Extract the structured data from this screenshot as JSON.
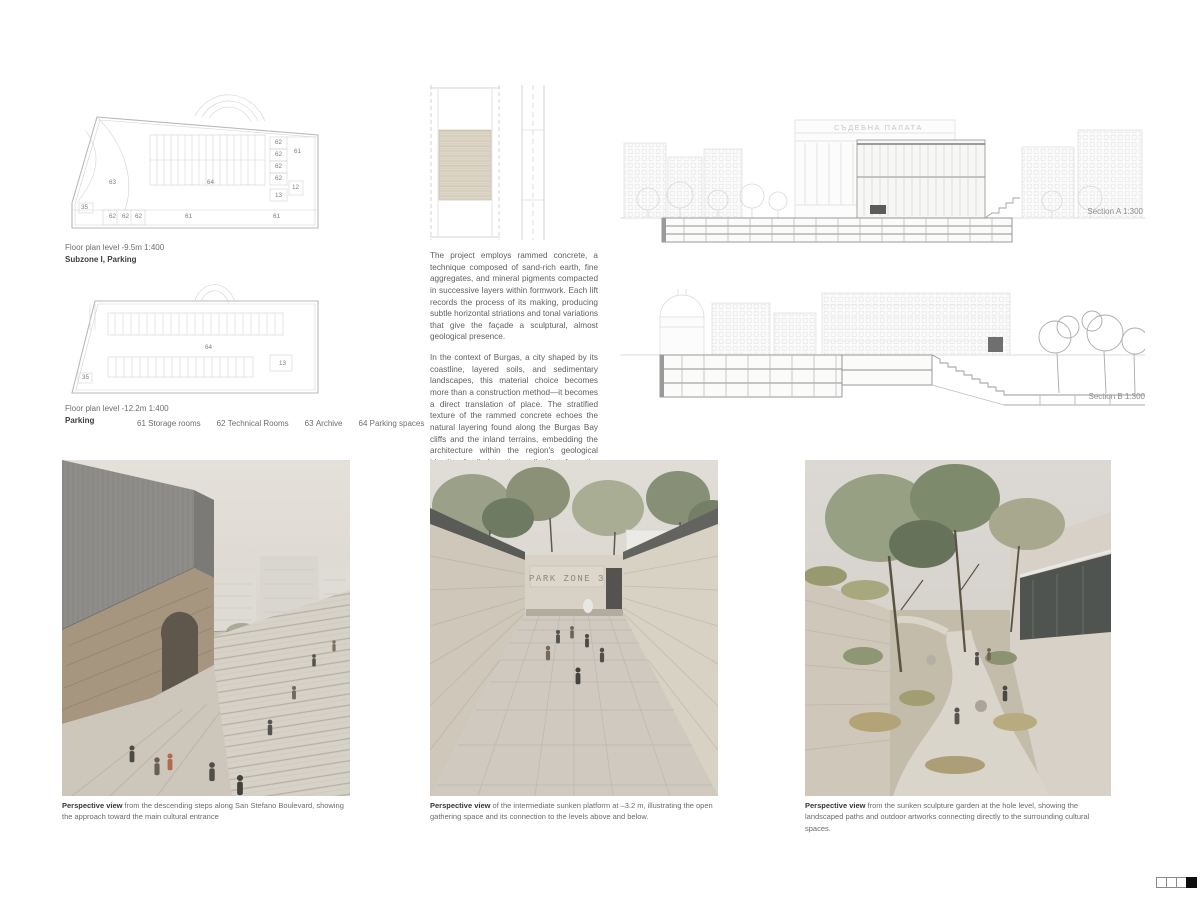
{
  "colors": {
    "background": "#ffffff",
    "drawing_line": "#cfcfcf",
    "text": "#606060",
    "caption_bold": "#363636",
    "indicator_filled": "#0e0e0e"
  },
  "plans": {
    "plan1": {
      "caption_scale": "Floor plan level -9.5m   1:400",
      "caption_name": "Subzone I, Parking",
      "labels": [
        "62",
        "62",
        "62",
        "62",
        "61",
        "12",
        "13",
        "63",
        "64",
        "35",
        "62",
        "62",
        "62",
        "61",
        "61"
      ]
    },
    "plan2": {
      "caption_scale": "Floor plan level -12.2m   1:400",
      "caption_name": "Parking",
      "labels": [
        "64",
        "13",
        "35"
      ]
    },
    "legend": [
      {
        "code": "61",
        "label": "Storage rooms"
      },
      {
        "code": "62",
        "label": "Technical Rooms"
      },
      {
        "code": "63",
        "label": "Archive"
      },
      {
        "code": "64",
        "label": "Parking spaces"
      }
    ]
  },
  "material_text": {
    "paragraph1": "The project employs rammed concrete, a technique composed of sand-rich earth, fine aggregates, and mineral pigments compacted in successive layers within formwork. Each lift records the process of its making, producing subtle horizontal striations and tonal variations that give the façade a sculptural, almost geological presence.",
    "paragraph2": "In the context of Burgas, a city shaped by its coastline, layered soils, and sedimentary landscapes, this material choice becomes more than a construction method—it becomes a direct translation of place. The stratified texture of the rammed concrete echoes the natural layering found along the Burgas Bay cliffs and the inland terrains, embedding the architecture within the region's geological identity. Applied to the walls that form the edges of the hole level, the material reinforces the reading of the sunken spaces as carved ground, while its continuation on the cube above creates a unifying language between what is buried and what rises at street level."
  },
  "sections": {
    "section_a": {
      "label": "Section A   1:300",
      "building_sign": "СЪДЕБНА ПАЛАТА"
    },
    "section_b": {
      "label": "Section B   1:300"
    }
  },
  "renders": [
    {
      "caption_lead": "Perspective view",
      "caption_text": " from the descending steps along San Stefano Boulevard, showing the approach toward the main cultural entrance"
    },
    {
      "caption_lead": "Perspective view",
      "caption_text": " of the intermediate sunken platform at –3.2 m, illustrating the open gathering space and its connection to the levels above and below.",
      "sign": "PARK ZONE 3"
    },
    {
      "caption_lead": "Perspective view",
      "caption_text": " from the sunken sculpture garden at the hole level, showing the landscaped paths and outdoor artworks connecting directly to the surrounding cultural spaces."
    }
  ],
  "page_indicator": {
    "pages": [
      {
        "state": "empty"
      },
      {
        "state": "empty"
      },
      {
        "state": "empty"
      },
      {
        "state": "filled"
      }
    ]
  }
}
